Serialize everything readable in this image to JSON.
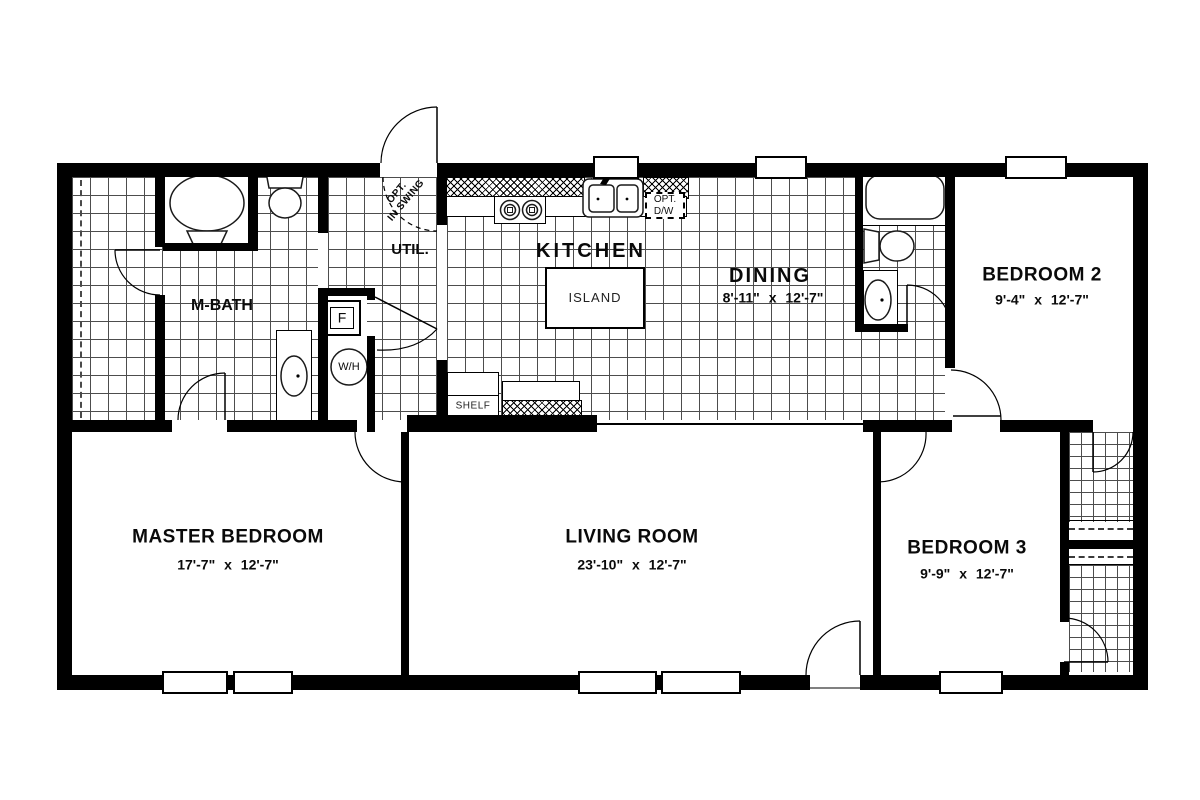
{
  "plan": {
    "rooms": [
      {
        "name": "MASTER BEDROOM",
        "dims": "17'-7\" x 12'-7\""
      },
      {
        "name": "LIVING ROOM",
        "dims": "23'-10\" x 12'-7\""
      },
      {
        "name": "BEDROOM 3",
        "dims": "9'-9\" x 12'-7\""
      },
      {
        "name": "BEDROOM 2",
        "dims": "9'-4\" x 12'-7\""
      },
      {
        "name": "DINING",
        "dims": "8'-11\" x 12'-7\""
      }
    ],
    "areas": {
      "kitchen": "KITCHEN",
      "util": "UTIL.",
      "mbath": "M-BATH"
    },
    "features": {
      "island": "ISLAND",
      "shelf": "SHELF",
      "furnace": "F",
      "water_heater": "W/H"
    },
    "annotations": {
      "opt_dw": [
        "OPT.",
        "D/W"
      ],
      "opt_inswing": [
        "OPT.",
        "IN SWING"
      ]
    },
    "colors": {
      "wall": "#000000",
      "floor_grid_line": "#4d4d4d",
      "background": "#ffffff"
    }
  }
}
